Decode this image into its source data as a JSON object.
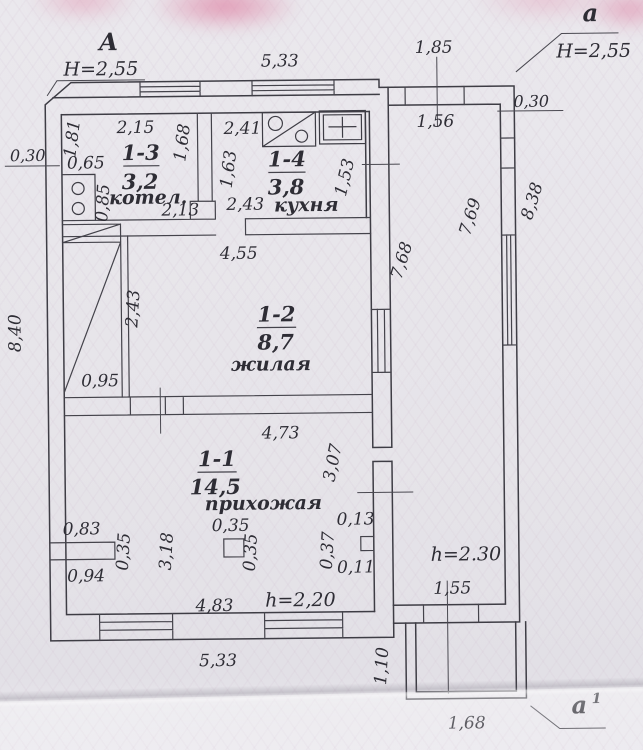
{
  "palette": {
    "paper": "#e8e6eb",
    "ink": "#3e3d45",
    "guilloche_pink": "#e69ab8"
  },
  "markers": {
    "left": {
      "label": "А",
      "height": "Н=2,55"
    },
    "right": {
      "label": "а",
      "height": "Н=2,55"
    },
    "bottom": {
      "label": "а",
      "sup": "1"
    }
  },
  "rooms": [
    {
      "number": "1-3",
      "area": "3,2",
      "name": "котел."
    },
    {
      "number": "1-4",
      "area": "3,8",
      "name": "кухня"
    },
    {
      "number": "1-2",
      "area": "8,7",
      "name": "жилая"
    },
    {
      "number": "1-1",
      "area": "14,5",
      "name": "прихожая"
    }
  ],
  "heights": {
    "hallway": "h=2,20",
    "veranda": "h=2.30"
  },
  "dims": {
    "top_main": "5,33",
    "top_veranda": "1,85",
    "veranda_top_inner": "1,56",
    "left_thickness": "0,30",
    "left_total": "8,40",
    "right_thickness": "0,30",
    "right_total": "8,38",
    "veranda_inner": "7,69",
    "house_veranda_wall": "7,68",
    "r13_left": "1,81",
    "r13_top": "2,15",
    "r13_left_low": "0,65",
    "r13_right": "1,68",
    "r13_closet": "0,85",
    "r13_bottom": "2,13",
    "r14_top": "2,41",
    "r14_left": "1,63",
    "r14_bottom": "2,43",
    "r14_right": "1,53",
    "r12_top": "4,55",
    "r12_left": "2,43",
    "r12_strip": "0,95",
    "r11_top": "4,73",
    "r11_right": "3,07",
    "stub_top": "0,83",
    "stub_width": "0,35",
    "stub_bottom": "0,94",
    "r11_mid": "3,18",
    "col_top": "0,35",
    "col_side": "0,35",
    "shaft_top": "0,13",
    "shaft_side": "0,37",
    "shaft_bottom": "0,11",
    "r11_bottom": "4,83",
    "bottom_main": "5,33",
    "porch_depth": "1,10",
    "porch_width": "1,68",
    "veranda_door": "1,55"
  }
}
